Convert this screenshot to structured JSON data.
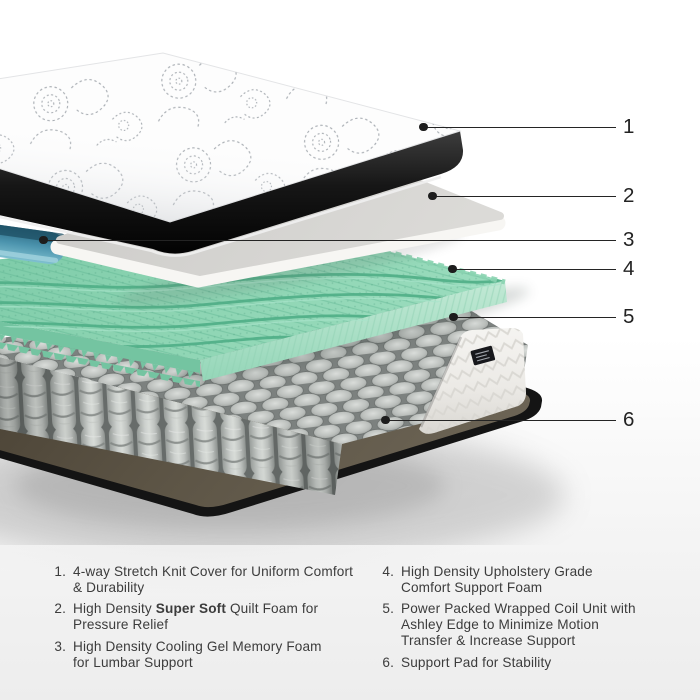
{
  "callouts": [
    {
      "number": "1"
    },
    {
      "number": "2"
    },
    {
      "number": "3"
    },
    {
      "number": "4"
    },
    {
      "number": "5"
    },
    {
      "number": "6"
    }
  ],
  "legend": {
    "items": [
      {
        "number": "1.",
        "lines": [
          {
            "pre": "4-way Stretch Knit Cover for Uniform Comfort",
            "bold": "",
            "post": ""
          },
          {
            "pre": "& Durability",
            "bold": "",
            "post": ""
          }
        ]
      },
      {
        "number": "2.",
        "lines": [
          {
            "pre": "High Density ",
            "bold": "Super Soft",
            "post": " Quilt Foam for"
          },
          {
            "pre": "Pressure Relief",
            "bold": "",
            "post": ""
          }
        ]
      },
      {
        "number": "3.",
        "lines": [
          {
            "pre": "High Density Cooling Gel Memory Foam",
            "bold": "",
            "post": ""
          },
          {
            "pre": "for Lumbar Support",
            "bold": "",
            "post": ""
          }
        ]
      },
      {
        "number": "4.",
        "lines": [
          {
            "pre": "High Density Upholstery Grade",
            "bold": "",
            "post": ""
          },
          {
            "pre": "Comfort Support Foam",
            "bold": "",
            "post": ""
          }
        ]
      },
      {
        "number": "5.",
        "lines": [
          {
            "pre": "Power Packed Wrapped Coil Unit with",
            "bold": "",
            "post": ""
          },
          {
            "pre": "Ashley Edge to Minimize Motion",
            "bold": "",
            "post": ""
          },
          {
            "pre": "Transfer & Increase Support",
            "bold": "",
            "post": ""
          }
        ]
      },
      {
        "number": "6.",
        "lines": [
          {
            "pre": "Support Pad for Stability",
            "bold": "",
            "post": ""
          }
        ]
      }
    ]
  },
  "illustration": {
    "layer_colors": {
      "knit_cover": "#ffffff",
      "cover_band": "#161616",
      "quilt_foam_slab": "#d4d3d0",
      "cooling_gel_foam": "#4b93ad",
      "comfort_foam_green": "#8ad3b0",
      "coil_unit_grey": "#c6c9c7",
      "ashley_edge_panel": "#f1f0ed",
      "support_pad_brown": "#5a5244",
      "callout_line": "#242424"
    }
  }
}
